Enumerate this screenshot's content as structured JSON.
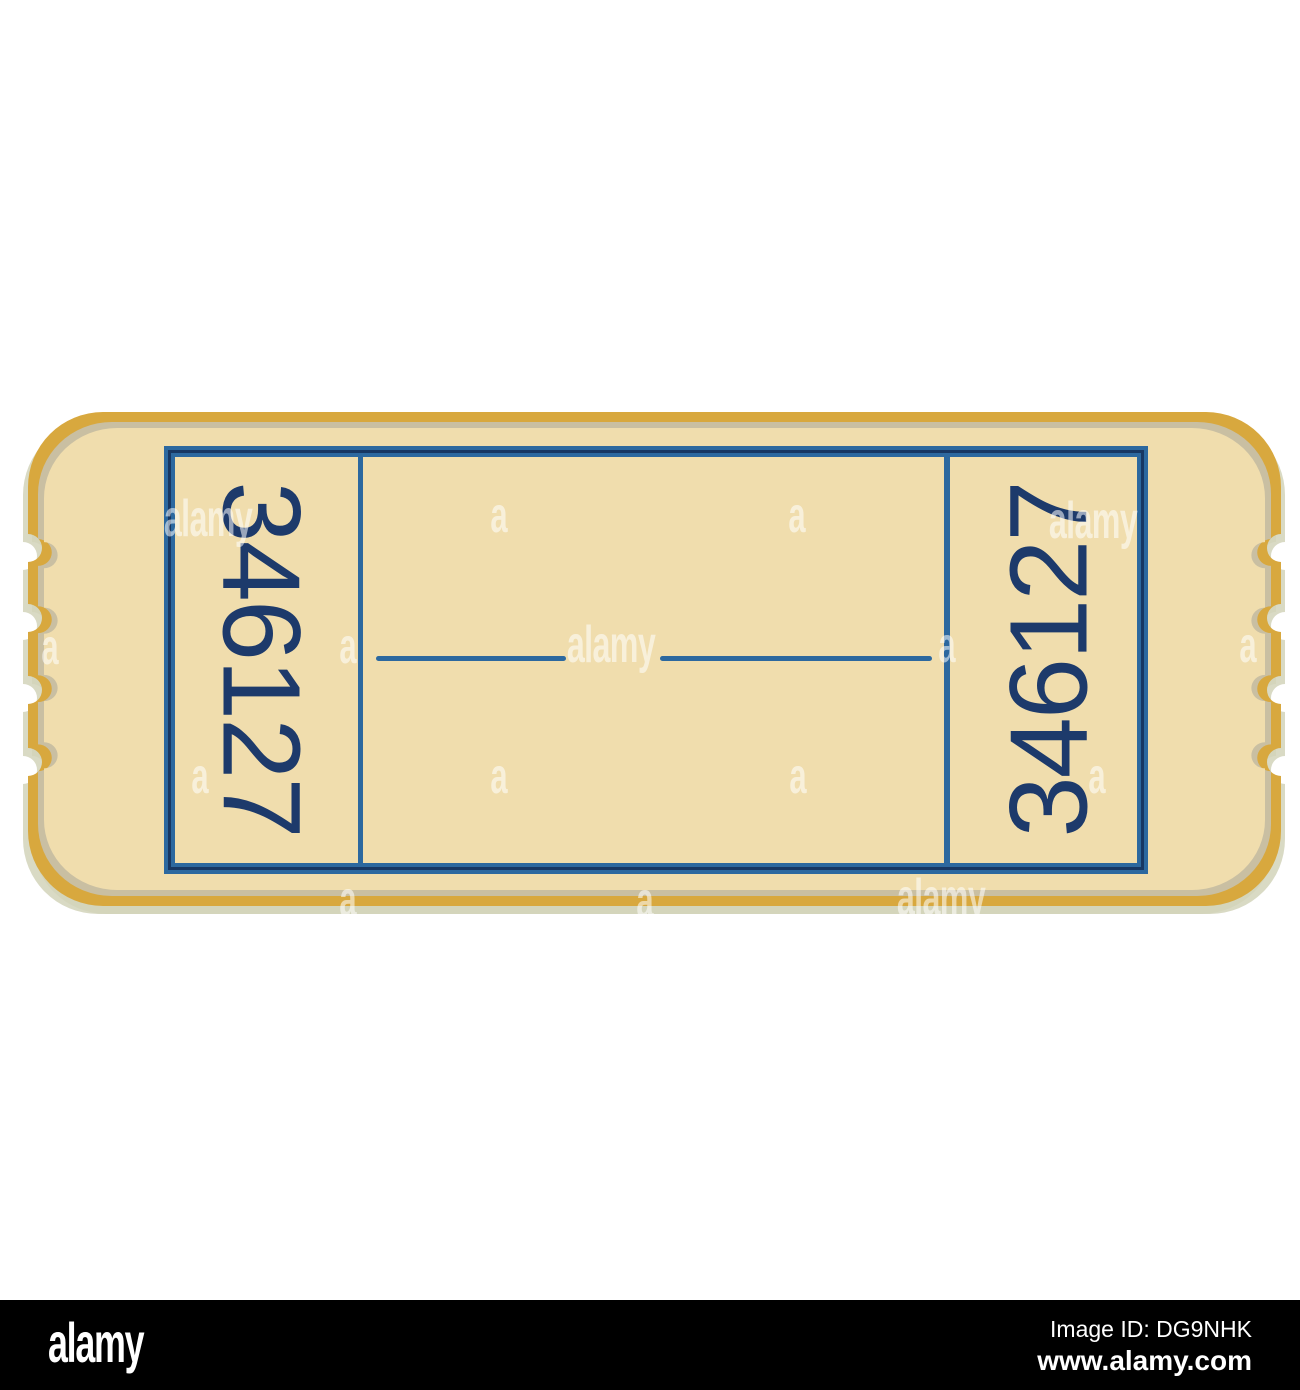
{
  "image": {
    "width": 1300,
    "height": 1390,
    "background": "#ffffff",
    "subject": "blank admission ticket illustration"
  },
  "ticket": {
    "serial_number": "346127",
    "colors": {
      "body_cream": "#F0DDAD",
      "border_gold": "#D8A83E",
      "inner_shadow_band": "#C9BFA2",
      "drop_shadow": "#D2D3BA",
      "frame_blue": "#2C689F",
      "frame_navy_line": "#173763",
      "serial_navy": "#1D3A6B"
    }
  },
  "watermarks": {
    "brand_word": "alamy",
    "brand_letter": "a",
    "color": "rgba(255,255,255,0.55)"
  },
  "footer": {
    "brand_logo": "alamy",
    "image_id": "Image ID: DG9NHK",
    "website": "www.alamy.com",
    "background": "#000000"
  }
}
